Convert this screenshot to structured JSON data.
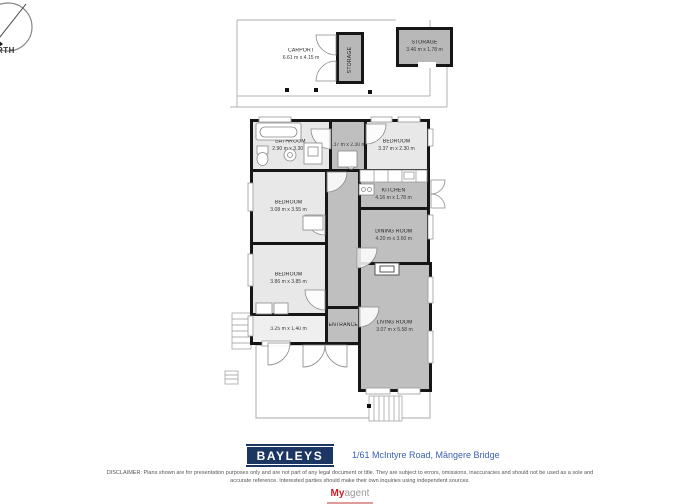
{
  "compass": {
    "north_label": "NORTH"
  },
  "outdoor": {
    "carport": {
      "name": "CARPORT",
      "dims": "6.61 m x 4.15 m"
    },
    "storage_attached": {
      "name": "STORAGE"
    },
    "storage_detached": {
      "name": "STORAGE",
      "dims": "3.46 m x 1.78 m"
    }
  },
  "rooms": {
    "bathroom": {
      "name": "BATHROOM",
      "dims": "2.90 m x 3.30 m"
    },
    "hall_top": {
      "dims": "2.37 m x 2.30 m"
    },
    "bedroom_top": {
      "name": "BEDROOM",
      "dims": "3.37 m x 2.30 m"
    },
    "bedroom_mid": {
      "name": "BEDROOM",
      "dims": "3.08 m x 3.55 m"
    },
    "kitchen": {
      "name": "KITCHEN",
      "dims": "4.16 m x 1.78 m"
    },
    "dining": {
      "name": "DINING ROOM",
      "dims": "4.20 m x 3.60 m"
    },
    "bedroom_bottom": {
      "name": "BEDROOM",
      "dims": "3.86 m x 3.85 m"
    },
    "porch": {
      "dims": "3.25 m x 1.40 m"
    },
    "entrance": {
      "name": "ENTRANCE"
    },
    "living": {
      "name": "LIVING ROOM",
      "dims": "3.07 m x 5.58 m"
    }
  },
  "footer": {
    "brand": "BAYLEYS",
    "address": "1/61 McIntyre Road, Māngere Bridge",
    "disclaimer_line1": "DISCLAIMER: Plans shown are for presentation purposes only and are not part of any legal document or title. They are subject to errors, omissions, inaccuracies and should not be used as a sole and",
    "disclaimer_line2": "accurate reference. Interested parties should make their own inquiries using independent sources.",
    "logo_my": "My",
    "logo_agent": "agent"
  },
  "colors": {
    "brand_navy": "#1c3664",
    "address_blue": "#3a62ae",
    "myagent_red": "#cc2027",
    "wall_black": "#161616",
    "room_light": "#e8e8e8",
    "room_dark": "#bfbfbf"
  }
}
